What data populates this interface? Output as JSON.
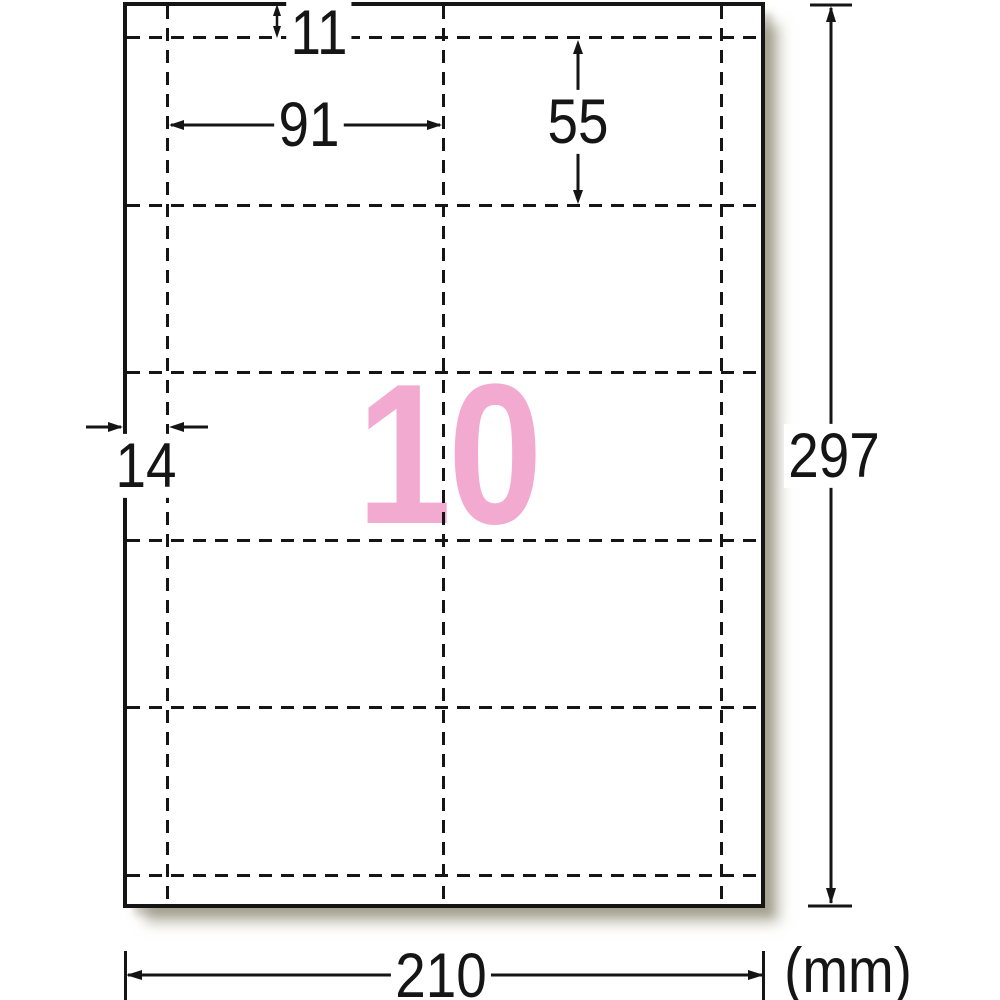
{
  "diagram": {
    "title_semantic": "label-sheet-dimension-diagram",
    "sheet_count_label": "10",
    "sheet_count_color": "#F3AAD0",
    "unit_label": "(mm)",
    "line_color": "#151515",
    "paper_color": "#ffffff",
    "grid": {
      "columns": 2,
      "rows": 5,
      "total_labels": 10
    },
    "dimensions": {
      "top_margin": "11",
      "card_width": "91",
      "card_height": "55",
      "side_margin": "14",
      "sheet_height": "297",
      "sheet_width": "210"
    }
  }
}
